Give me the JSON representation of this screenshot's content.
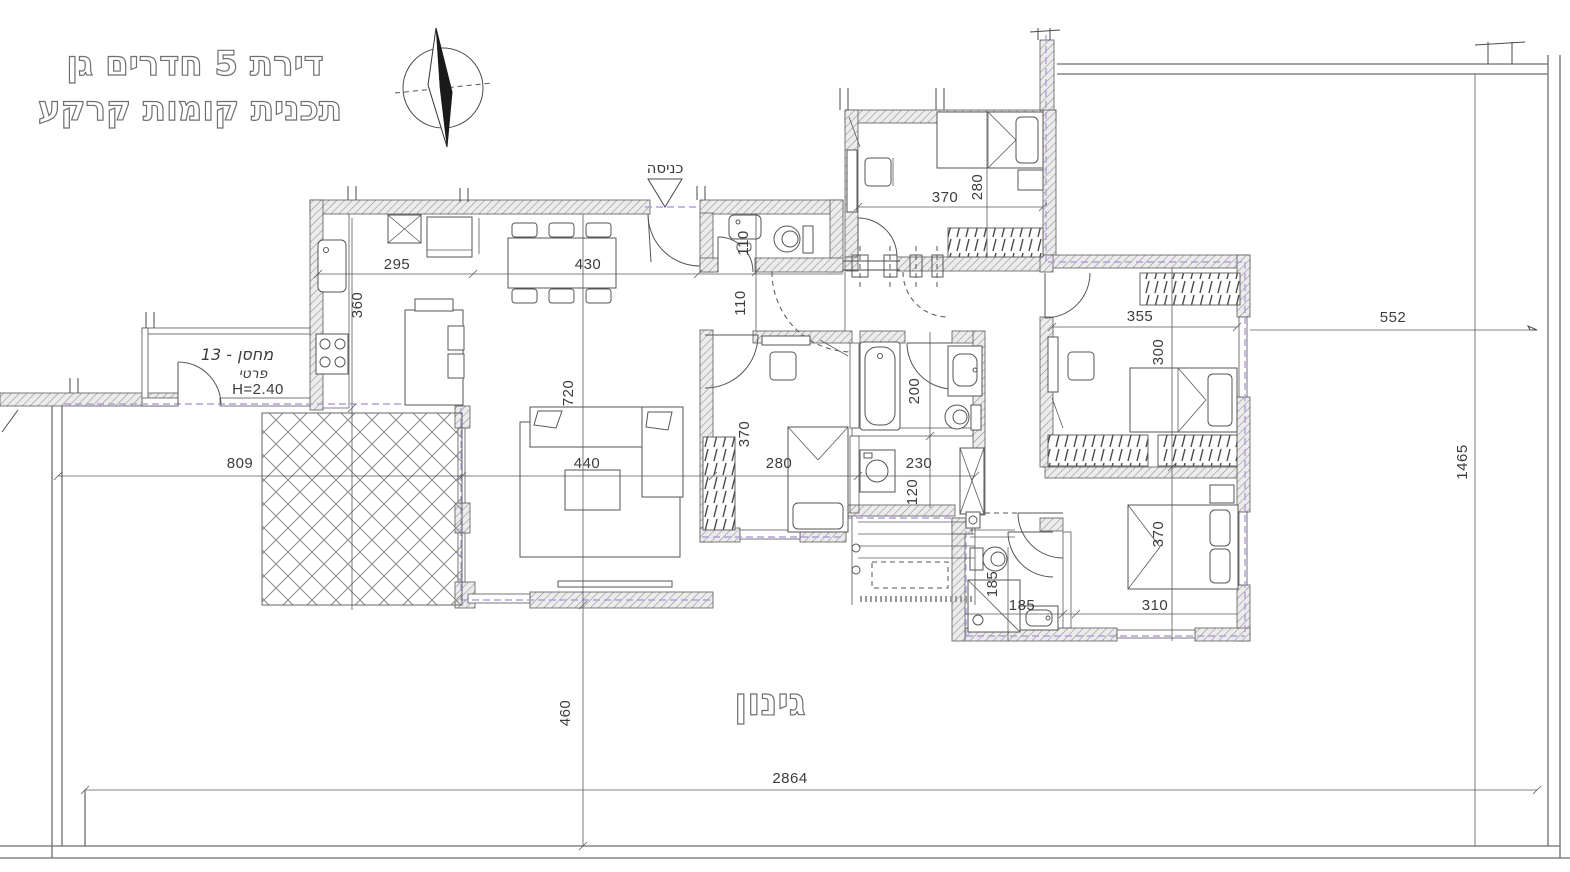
{
  "title": {
    "line1": "דירת 5 חדרים גן",
    "line2": "תכנית קומות קרקע"
  },
  "compass": {
    "icon": "north-arrow-compass"
  },
  "entrance": {
    "label": "כניסה",
    "icon": "entrance-triangle-marker"
  },
  "storage": {
    "line1": "מחסן - 13",
    "line2": "פרטי",
    "line3": "H=2.40"
  },
  "garden": {
    "label": "גינון"
  },
  "dimensions": {
    "kitchen_width": "295",
    "dining_width": "430",
    "kitchen_depth": "360",
    "wc_depth": "110",
    "hall_depth": "110",
    "bedroom1_width": "370",
    "bedroom1_depth": "280",
    "bedroom2_width": "355",
    "bedroom2_depth": "300",
    "east_side": "552",
    "living_depth": "720",
    "living_width": "440",
    "west_side": "809",
    "bedroom3_width": "280",
    "bedroom3_depth": "370",
    "bathroom_depth": "200",
    "laundry_width": "230",
    "laundry_depth": "120",
    "bathroom2_depth": "185",
    "bathroom2_width": "185",
    "master_depth": "370",
    "master_width": "310",
    "garden_depth": "460",
    "plot_width": "2864",
    "plot_depth": "1465"
  },
  "colors": {
    "line": "#4a4a4a",
    "wall_hatch": "#8d8d8d",
    "boundary": "#6e6e6e",
    "property_dash": "#b49fdc",
    "background": "#ffffff"
  }
}
